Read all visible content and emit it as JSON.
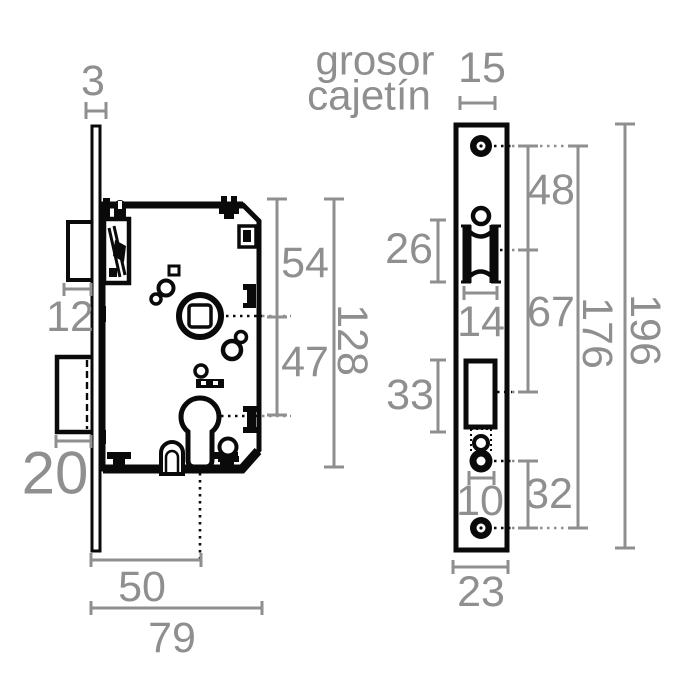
{
  "title": {
    "line1": "grosor",
    "line2": "cajetín"
  },
  "colors": {
    "drawing": "#0a0a0a",
    "dimension": "#8f8f8f",
    "background": "#ffffff"
  },
  "side_view": {
    "plate_thickness": "3",
    "latch_protrusion": "12",
    "deadbolt_protrusion": "20",
    "top_to_spindle": "54",
    "spindle_to_cylinder": "47",
    "case_height": "128",
    "backset": "50",
    "total_depth": "79"
  },
  "front_view": {
    "case_thickness": "15",
    "screw_to_latch": "48",
    "latch_opening_height": "26",
    "latch_opening_width": "14",
    "latch_to_bolt": "67",
    "bolt_opening_height": "33",
    "cylinder_width": "10",
    "cylinder_to_screw": "32",
    "screw_spacing": "176",
    "faceplate_height": "196",
    "faceplate_width": "23"
  }
}
